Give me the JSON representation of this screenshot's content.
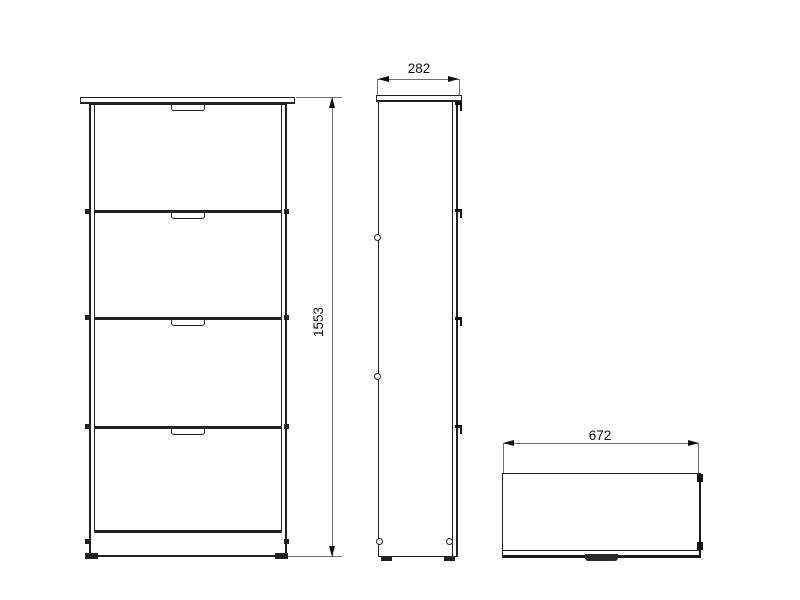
{
  "drawing": {
    "dimensions": {
      "height": "1553",
      "depth": "282",
      "width": "672"
    },
    "colors": {
      "background": "#ffffff",
      "outline": "#222222",
      "dimension_line": "#707070",
      "dimension_text": "#111111"
    }
  }
}
